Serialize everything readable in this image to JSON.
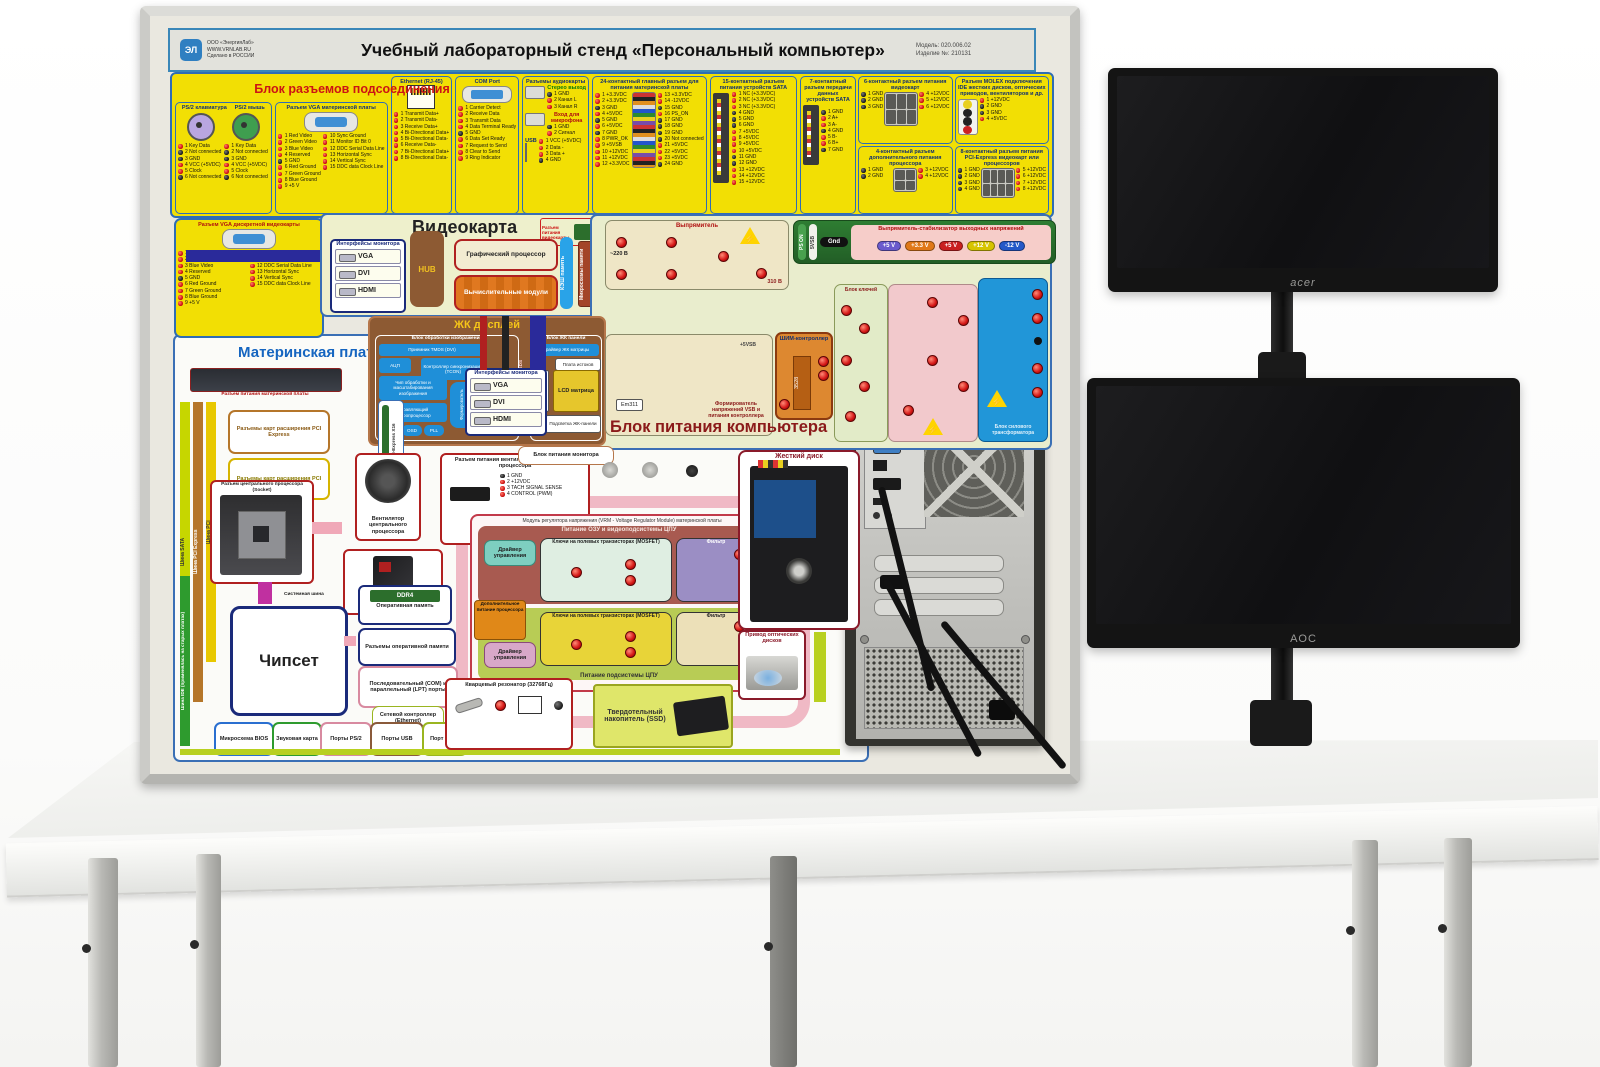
{
  "board": {
    "header": {
      "logo_mark": "ЭЛ",
      "logo_line1": "ООО «ЭнергияЛаб»",
      "logo_line2": "WWW.VRNLAB.RU",
      "logo_line3": "Сделано в РОССИИ",
      "title": "Учебный лабораторный стенд «Персональный компьютер»",
      "model": "Модель: 020.006.02",
      "serial": "Изделие №: 210131"
    },
    "conn": {
      "title": "Блок разъемов подсоединения",
      "ps2kb": {
        "title": "PS/2 клавиатура",
        "pins": [
          "1 Key Data",
          "2 Not connected",
          "3 GND",
          "4 VCC (+5VDC)",
          "5 Clock",
          "6 Not connected"
        ]
      },
      "ps2mouse": {
        "title": "PS/2 мышь",
        "pins": [
          "1 Key Data",
          "2 Not connected",
          "3 GND",
          "4 VCC (+5VDC)",
          "5 Clock",
          "6 Not connected"
        ]
      },
      "vga_mb": {
        "title": "Разъем VGA материнской платы",
        "pins_left": [
          "1 Red Video",
          "2 Green Video",
          "3 Blue Video",
          "4 Reserved",
          "5 GND",
          "6 Red Ground",
          "7 Green Ground",
          "8 Blue Ground",
          "9 +5 V"
        ],
        "pins_right": [
          "10 Sync Ground",
          "11 Monitor ID Bit 0",
          "12 DDC Serial Data Line",
          "13 Horizontal Sync",
          "14 Vertical Sync",
          "15 DDC data Clock Line"
        ]
      },
      "ethernet": {
        "title": "Ethernet (RJ-45)",
        "pins": [
          "1 Transmit Data+",
          "2 Transmit Data-",
          "3 Receive Data+",
          "4 Bi-Directional Data+",
          "5 Bi-Directional Data-",
          "6 Receive Data-",
          "7 Bi-Directional Data+",
          "8 Bi-Directional Data-"
        ]
      },
      "com": {
        "title": "COM Port",
        "pins": [
          "1 Carrier Detect",
          "2 Receive Data",
          "3 Transmit Data",
          "4 Data Terminal Ready",
          "5 GND",
          "6 Data Set Ready",
          "7 Request to Send",
          "8 Clear to Send",
          "9 Ring Indicator"
        ]
      },
      "audio": {
        "title": "Разъемы аудиокарты",
        "stereo_title": "Стерео выход",
        "stereo_pins": [
          "1 GND",
          "2 Канал L",
          "3 Канал R"
        ],
        "mic_title": "Вход для микрофона",
        "mic_pins": [
          "1 GND",
          "2 Сигнал"
        ],
        "usb_title": "USB",
        "usb_pins": [
          "1 VCC (+5VDC)",
          "2 Data -",
          "3 Data +",
          "4 GND"
        ]
      },
      "atx24": {
        "title": "24-контактный главный разъем для питания материнской платы",
        "pins_left": [
          "1 +3.3VDC",
          "2 +3.3VDC",
          "3 GND",
          "4 +5VDC",
          "5 GND",
          "6 +5VDC",
          "7 GND",
          "8 PWR_OK",
          "9 +5VSB",
          "10 +12VDC",
          "11 +12VDC",
          "12 +3.3VDC"
        ],
        "pins_right": [
          "13 +3.3VDC",
          "14 -12VDC",
          "15 GND",
          "16 PS_ON",
          "17 GND",
          "18 GND",
          "19 GND",
          "20 Not connected",
          "21 +5VDC",
          "22 +5VDC",
          "23 +5VDC",
          "24 GND"
        ]
      },
      "sata15": {
        "title": "15-контактный разъем питания устройств SATA",
        "pins": [
          "1 NC (+3.3VDC)",
          "2 NC (+3.3VDC)",
          "3 NC (+3.3VDC)",
          "4 GND",
          "5 GND",
          "6 GND",
          "7 +5VDC",
          "8 +5VDC",
          "9 +5VDC",
          "10 +5VDC",
          "11 GND",
          "12 GND",
          "13 +12VDC",
          "14 +12VDC",
          "15 +12VDC"
        ]
      },
      "sata7": {
        "title": "7-контактный разъем передачи данных устройств SATA",
        "pins": [
          "1 GND",
          "2 A+",
          "3 A-",
          "4 GND",
          "5 B-",
          "6 B+",
          "7 GND"
        ]
      },
      "pcie6": {
        "title": "6-контактный разъем питания видеокарт",
        "pins_left": [
          "1 GND",
          "2 GND",
          "3 GND"
        ],
        "pins_right": [
          "4 +12VDC",
          "5 +12VDC",
          "6 +12VDC"
        ]
      },
      "molex": {
        "title": "Разъем MOLEX подключения IDE жестких дисков, оптических приводов, вентиляторов и др.",
        "pins": [
          "1 +12VDC",
          "2 GND",
          "3 GND",
          "4 +5VDC"
        ]
      },
      "cpu4": {
        "title": "4-контактный разъем дополнительного питания процессора",
        "pins_left": [
          "1 GND",
          "2 GND"
        ],
        "pins_right": [
          "3 +12VDC",
          "4 +12VDC"
        ]
      },
      "pcie8": {
        "title": "8-контактный разъем питания PCI-Express видеокарт или процессоров",
        "pins_left": [
          "1 GND",
          "2 GND",
          "3 GND",
          "4 GND"
        ],
        "pins_right": [
          "5 +12VDC",
          "6 +12VDC",
          "7 +12VDC",
          "8 +12VDC"
        ]
      }
    },
    "vga_discrete": {
      "title": "Разъем VGA дискретной видеокарты",
      "pins_left": [
        "1 Red Video",
        "2 Green Video",
        "3 Blue Video",
        "4 Reserved",
        "5 GND",
        "6 Red Ground",
        "7 Green Ground",
        "8 Blue Ground",
        "9 +5 V"
      ],
      "pins_right": [
        "10 Sync Ground",
        "11 Monitor ID Bit 0",
        "12 DDC Serial Data Line",
        "13 Horizontal Sync",
        "14 Vertical Sync",
        "15 DDC data Clock Line"
      ]
    },
    "videocard": {
      "title": "Видеокарта",
      "mon_if": "Интерфейсы монитора",
      "ports": [
        "VGA",
        "DVI",
        "HDMI"
      ],
      "hub": "HUB",
      "gpu": "Графический процессор",
      "compute": "Вычислительные модули",
      "cache": "КЭШ память",
      "mem_chips": "Микросхемы памяти",
      "mem_ctrl": "Контроллеры памяти",
      "pwr": "Разъем питания видеокарты"
    },
    "lcd": {
      "title": "ЖК дисплей",
      "img_block": "Блок обработки изображения",
      "tmds": "Приемник TMDS (DVI)",
      "adc": "АЦП",
      "tcon": "Контроллер синхронизации (TCON)",
      "scaler": "Чип обработки и масштабирования изображения",
      "mcu": "Управляющий микропроцессор",
      "rom": "ROM",
      "osd": "OSD",
      "pll": "PLL",
      "former": "Формирователь выходного сигнала",
      "lvds": "LVDS",
      "rsds": "RSDS",
      "iface": "Интерфейсы LVDS/RSDS",
      "panel_block": "Блок ЖК панели",
      "driver": "Драйвер ЖК матрицы",
      "source": "Плата истоков",
      "gate": "Плата затворов",
      "matrix": "LCD матрица",
      "backlight": "Подсветка ЖК-панели",
      "psu": "Блок питания монитора"
    },
    "psu": {
      "title": "Блок питания компьютера",
      "rectifier": "Выпрямитель",
      "v220": "~220 В",
      "v310": "310 В",
      "ps_on": "PS ON",
      "vsb": "5VSB",
      "gnd": "Gnd",
      "wire_5vsb": "+5VSB",
      "stab": "Выпрямитель-стабилизатор выходных напряжений",
      "rails": [
        {
          "label": "+5 V",
          "color": "#6a5acd"
        },
        {
          "label": "+3.3 V",
          "color": "#e07818"
        },
        {
          "label": "+5 V",
          "color": "#c92020"
        },
        {
          "label": "+12 V",
          "color": "#d6c400"
        },
        {
          "label": "-12 V",
          "color": "#2458c8"
        }
      ],
      "keys": "Блок ключей",
      "pwm": "ШИМ-контроллер",
      "pwm_chip": "3528",
      "former": "Формирователь напряжений VSB и питания контроллера",
      "chip": "Em311",
      "transformer": "Блок силового трансформатора"
    },
    "mb": {
      "title": "Материнская плата",
      "power_conn": "Разъем питания материнской платы",
      "pcie_slots": "Разъемы карт расширения PCI Express",
      "pci_slots": "Разъемы карт расширения PCI",
      "bus_sata": "Шина SATA",
      "bus_pcie": "Шина PCI Express",
      "bus_pci": "Шина PCI",
      "bus_pcie16": "Шина PCI-Express X16",
      "bus_ide": "Шина IDE (применялась на старых платах)",
      "mon_if": "Интерфейсы монитора",
      "ports": [
        "VGA",
        "DVI",
        "HDMI"
      ],
      "socket": "Разъем центрального процессора (Socket)",
      "fan": "Вентилятор центрального процессора",
      "fan_conn": "Разъем питания вентилятора центрального процессора",
      "fan_pins": [
        "1 GND",
        "2 +12VDC",
        "3 TACH SIGNAL SENSE",
        "4 CONTROL (PWM)"
      ],
      "cpu": "Центральный процессор",
      "sysbus": "Системная шина",
      "chipset": "Чипсет",
      "ram": "Оперативная память",
      "ddr4": "DDR4",
      "ram_slots": "Разъемы оперативной памяти",
      "com_lpt": "Последовательный (COM) и параллельный (LPT) порты",
      "eth": "Сетевой контроллер (Ethernet)",
      "bios": "Микросхема BIOS",
      "sound": "Звуковая карта",
      "ps2": "Порты PS/2",
      "usb": "Порты USB",
      "rj45": "Порт RJ-45",
      "quartz": "Кварцевый резонатор (32768Гц)",
      "quartz_pins": [
        "1",
        "2"
      ],
      "ssd": "Твердотельный накопитель (SSD)",
      "vrm": {
        "title": "Модуль регулятора напряжения (VRM - Voltage Regulator Module) материнской платы",
        "top": "Питание ОЗУ и видеоподсистемы ЦПУ",
        "driver": "Драйвер управления",
        "mosfet": "Ключи на полевых транзисторах (MOSFET)",
        "filter": "Фильтр",
        "ustab": "Uстаб",
        "aux": "Дополнительное питание процессора",
        "bottom": "Питание подсистемы ЦПУ"
      },
      "hdd": "Жесткий диск",
      "odd": "Привод оптических дисков"
    }
  },
  "monitors": {
    "acer": "acer",
    "aoc": "AOC"
  }
}
